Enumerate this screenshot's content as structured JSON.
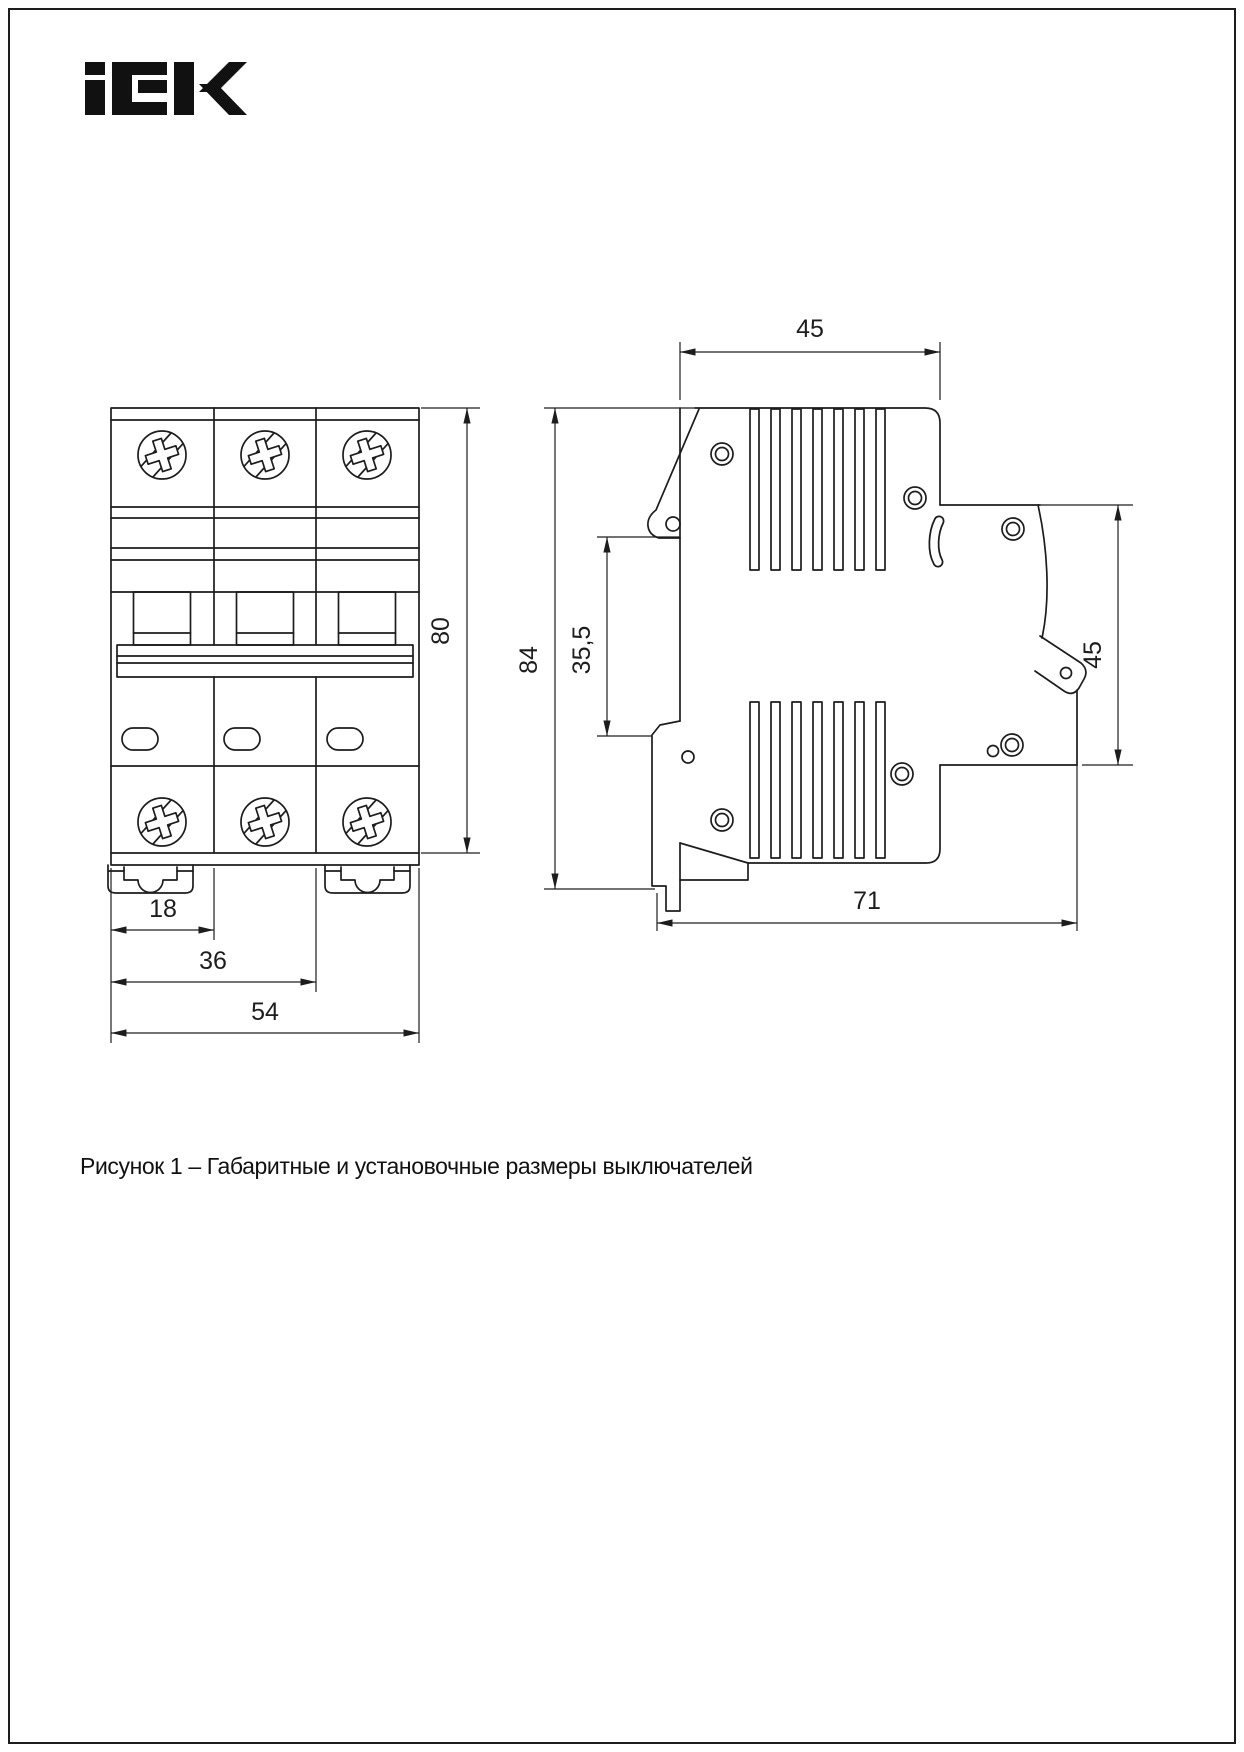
{
  "page": {
    "logo_text": "IEK",
    "caption": "Рисунок 1 – Габаритные и установочные размеры выключателей",
    "background": "#ffffff",
    "line_color": "#1d1d1d"
  },
  "dimensions": {
    "front": {
      "height": "80",
      "module_width": "18",
      "two_modules": "36",
      "overall_width": "54"
    },
    "side": {
      "top_depth": "45",
      "overall_height": "84",
      "rail_offset": "35,5",
      "rear_height": "45",
      "overall_depth": "71"
    }
  }
}
